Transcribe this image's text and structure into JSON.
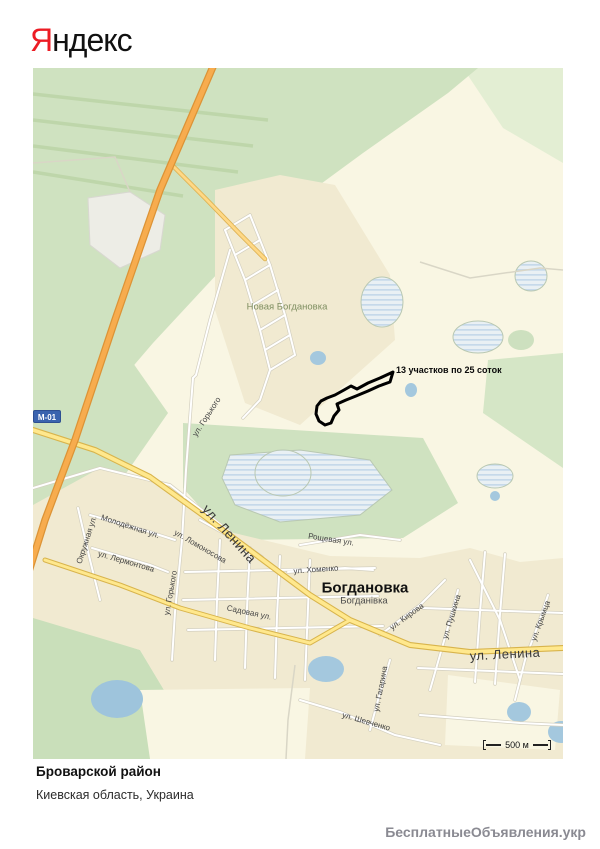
{
  "logo": {
    "first_letter": "Я",
    "rest": "ндекс"
  },
  "map": {
    "area_labels": {
      "nova_bogdanovka": "Новая Богдановка",
      "bogdanovka_ru": "Богдановка",
      "bogdanovka_ua": "Богданівка"
    },
    "street_labels": [
      {
        "text": "ул. Горького"
      },
      {
        "text": "ул. Горького"
      },
      {
        "text": "Молодёжная ул."
      },
      {
        "text": "Окружная ул."
      },
      {
        "text": "ул. Лермонтова"
      },
      {
        "text": "ул. Ломоносова"
      },
      {
        "text": "ул. Ленина"
      },
      {
        "text": "ул. Хоменко"
      },
      {
        "text": "Рощевая ул."
      },
      {
        "text": "ул. Кирова"
      },
      {
        "text": "ул. Пушкина"
      },
      {
        "text": "ул. Ленина"
      },
      {
        "text": "ул. Крымца"
      },
      {
        "text": "ул. Гагарина"
      },
      {
        "text": "ул. Шевченко"
      },
      {
        "text": "Садовая ул."
      }
    ],
    "annotation": "13 участков по 25 соток",
    "road_badge": "М-01",
    "scale_label": "500 м"
  },
  "footer": {
    "district": "Броварской район",
    "region": "Киевская область, Украина"
  },
  "watermark": "БесплатныеОбъявления.укр",
  "colors": {
    "logo_red": "#ec1c24",
    "highway_orange": "#f7ac4e",
    "road_yellow": "#ffe88d",
    "water_blue": "#a4c8de",
    "green_field": "#cfe2c0",
    "village_beige": "#f1ead1",
    "badge_blue": "#3a63ae",
    "plot_outline": "#000000",
    "watermark_gray": "#8a8a92"
  }
}
